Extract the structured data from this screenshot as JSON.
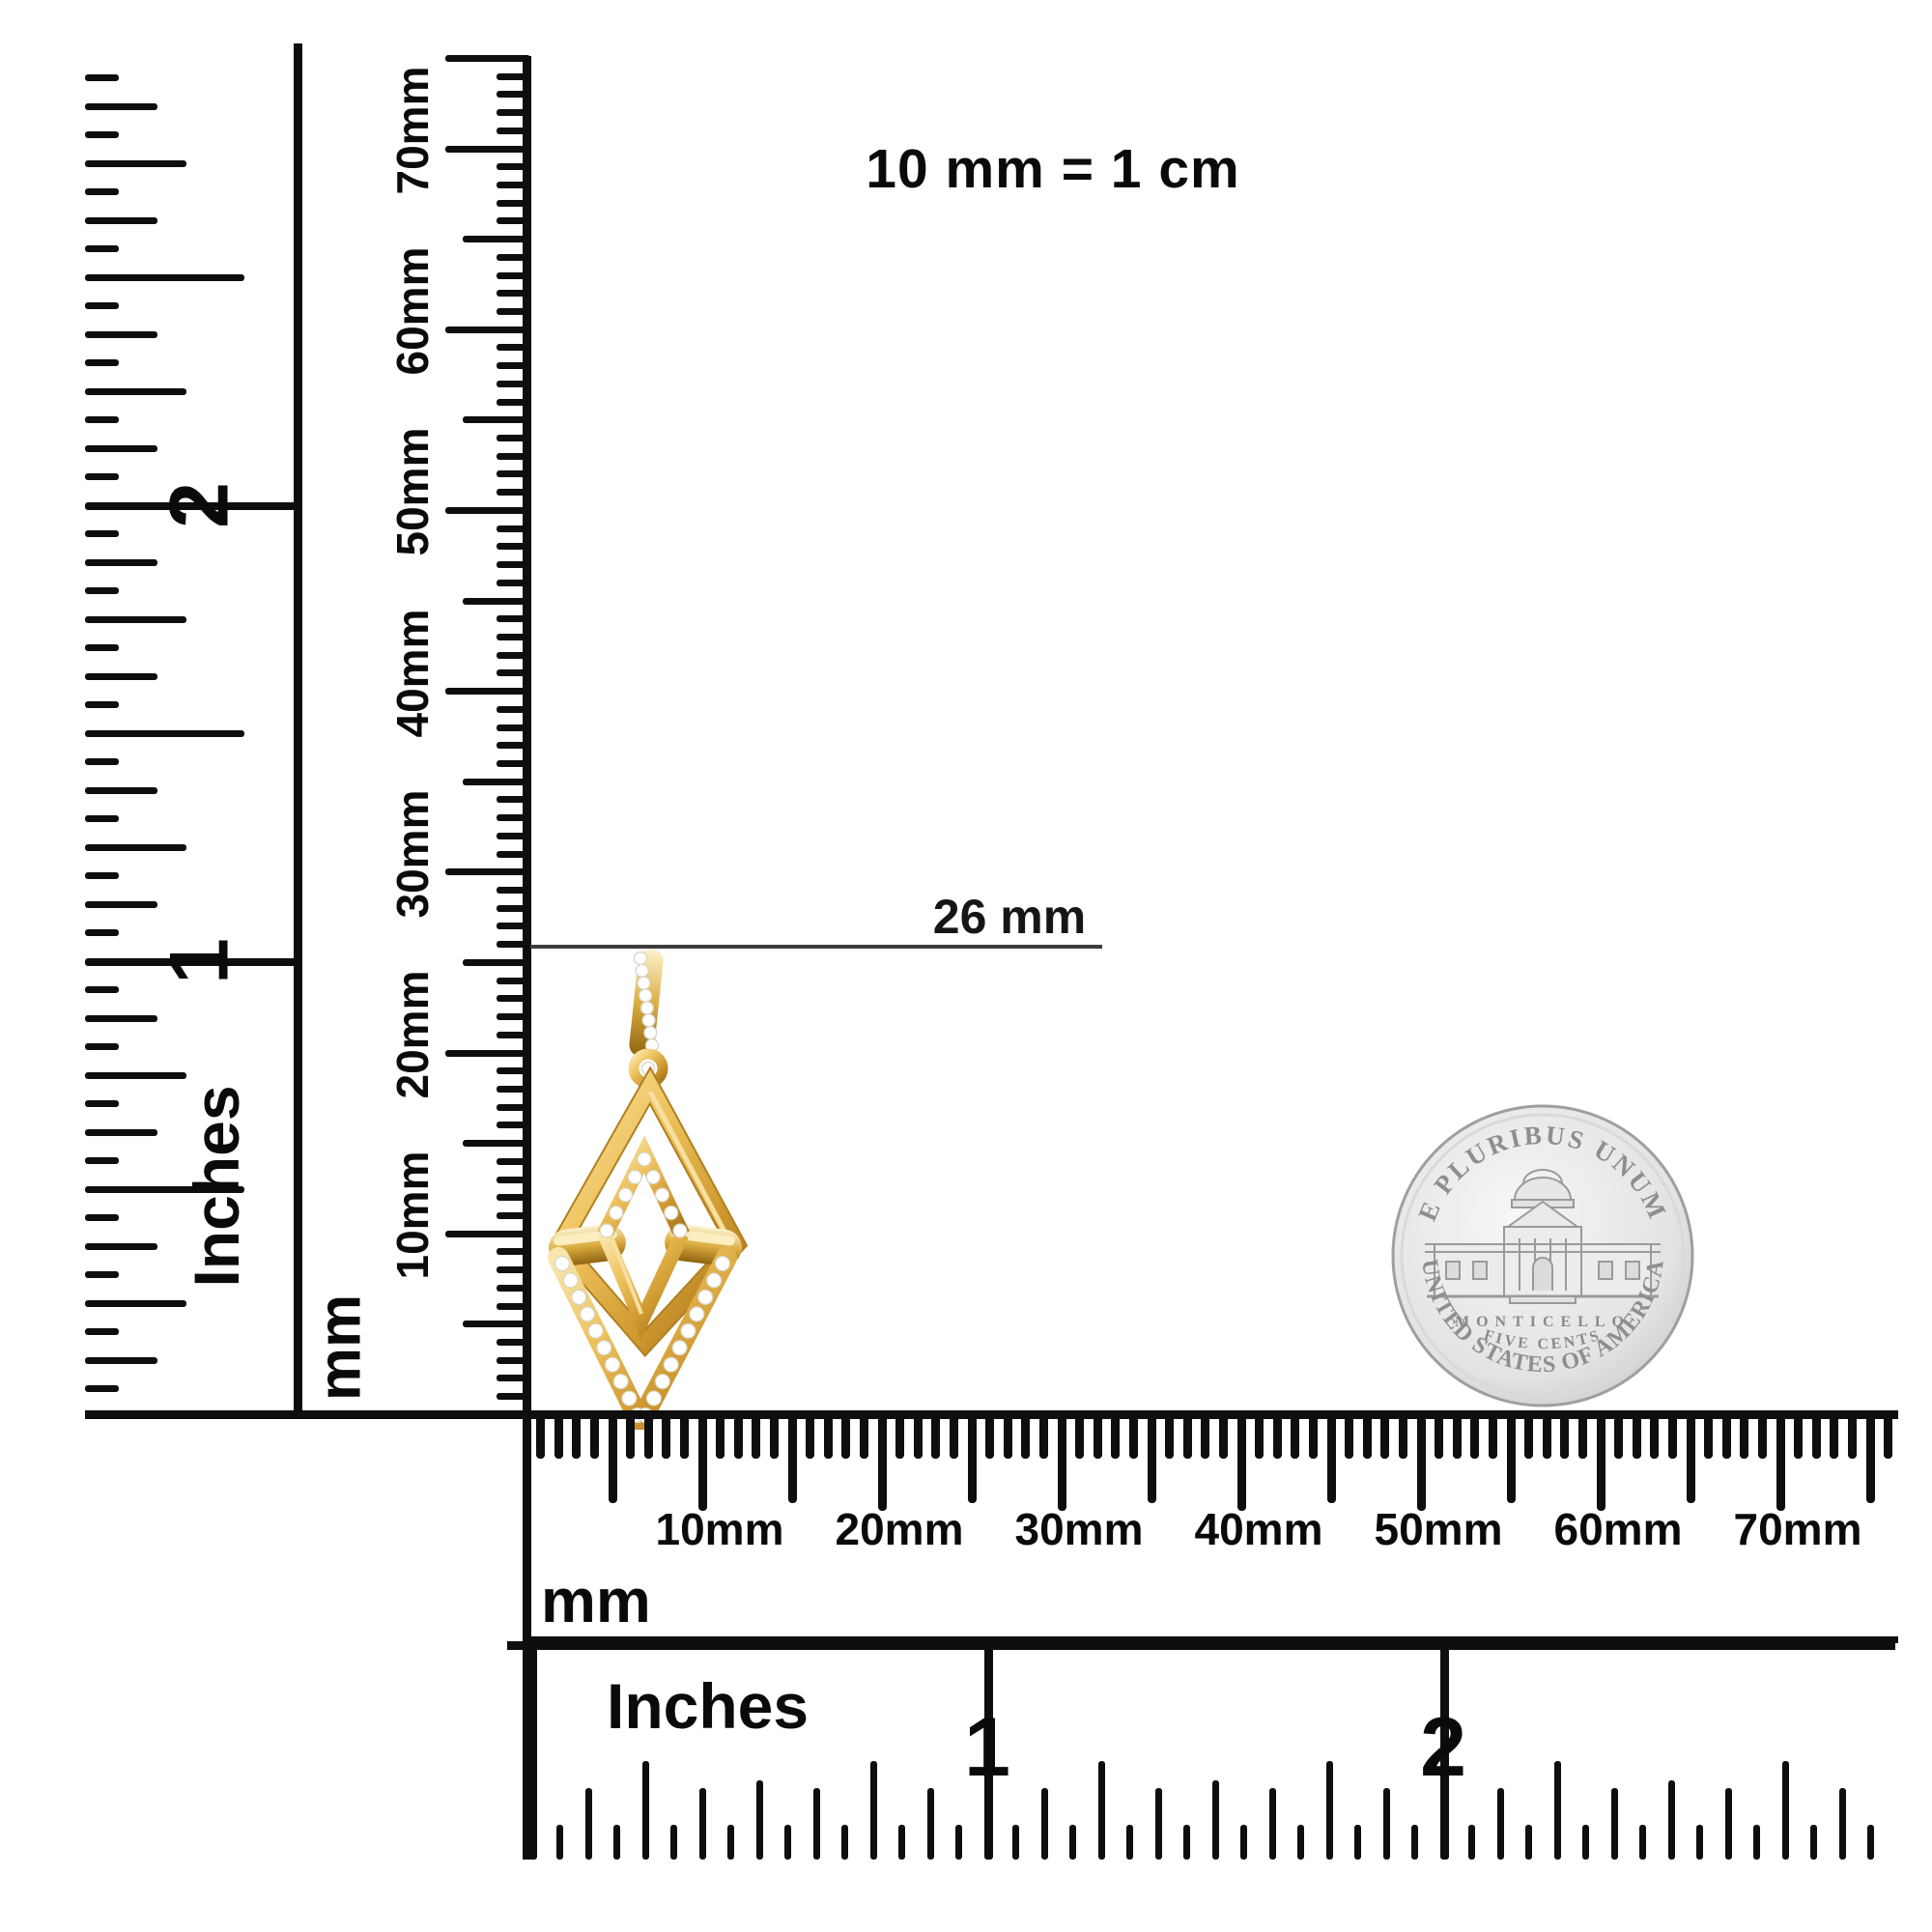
{
  "note": "10 mm = 1 cm",
  "annotation": {
    "text": "26 mm",
    "value_mm": 26
  },
  "vertical_inches_ruler": {
    "label": "Inches",
    "numerals": [
      "2",
      "1"
    ]
  },
  "vertical_mm_ruler": {
    "unit": "mm",
    "labels": [
      "70mm",
      "60mm",
      "50mm",
      "40mm",
      "30mm",
      "20mm",
      "10mm"
    ]
  },
  "bottom_mm_ruler": {
    "unit": "mm",
    "labels": [
      "10mm",
      "20mm",
      "30mm",
      "40mm",
      "50mm",
      "60mm",
      "70mm"
    ]
  },
  "bottom_inches_ruler": {
    "label": "Inches",
    "numerals": [
      "1",
      "2"
    ]
  },
  "coin": {
    "top_text": "E PLURIBUS UNUM",
    "building": "Monticello",
    "caption": "MONTICELLO",
    "denomination": "FIVE CENTS",
    "bottom_text": "UNITED STATES OF AMERICA",
    "color": "#d4d4d4"
  },
  "pendant": {
    "description": "yellow gold open rhombus pendant with pave diamonds",
    "gold_color": "#d9a62e",
    "diamond_color": "#ffffff"
  }
}
